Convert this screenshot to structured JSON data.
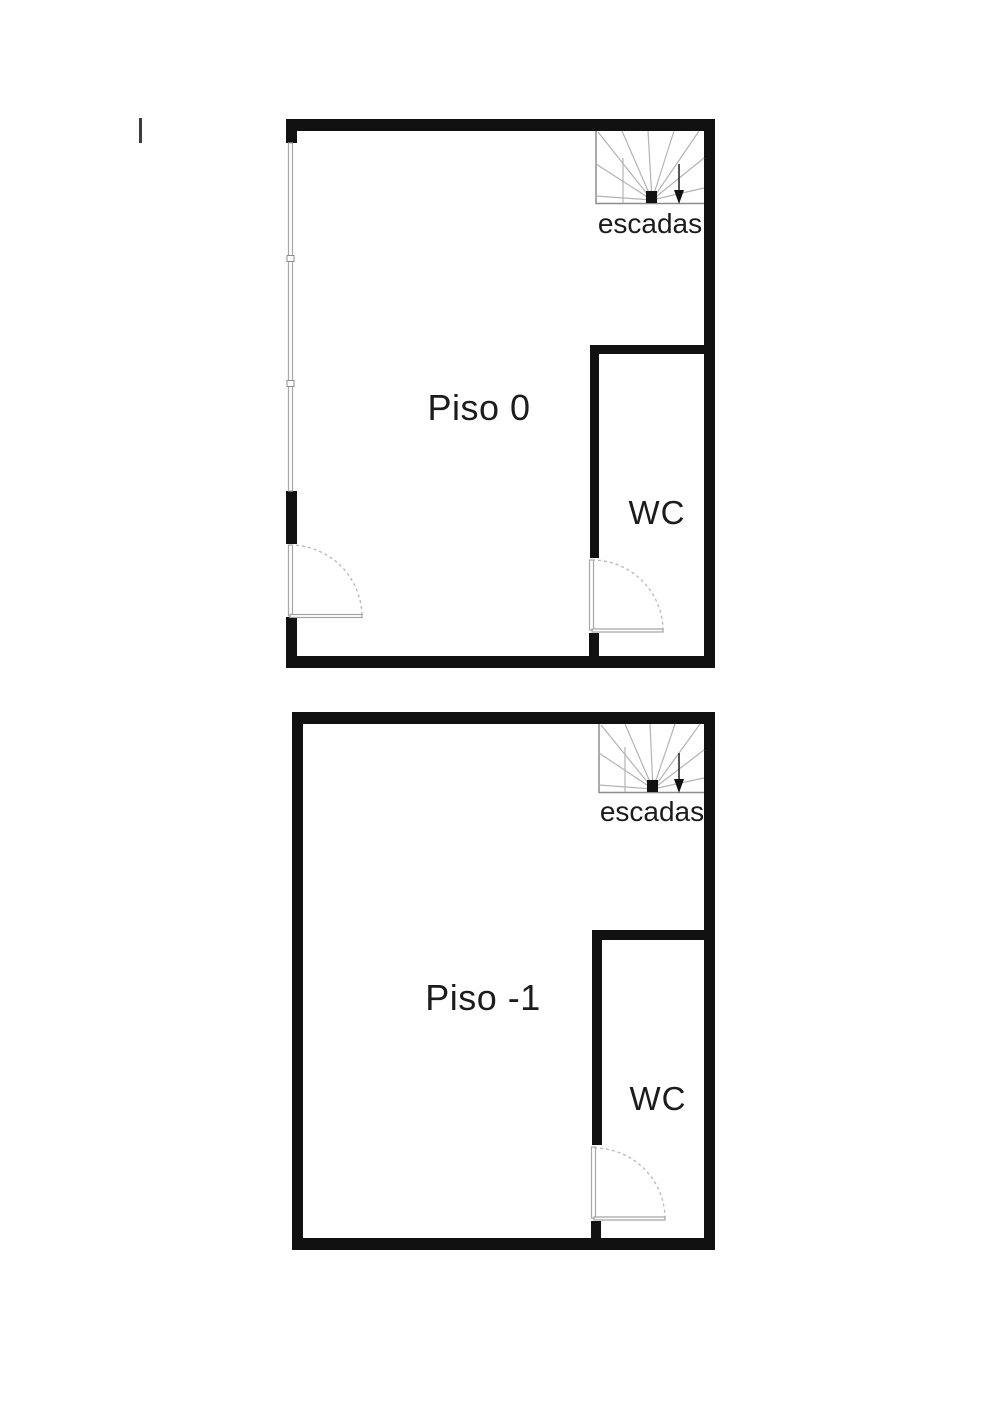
{
  "document": {
    "type": "floor-plan-drawing",
    "background_color": "#ffffff"
  },
  "colors": {
    "wall": "#111111",
    "window_line": "#a8a8a8",
    "door_swing": "#b8b8b8",
    "stairs_line": "#b4b4b4",
    "text": "#1c1c1c"
  },
  "floors": [
    {
      "id": "piso-0",
      "name_label": "Piso 0",
      "wc_label": "WC",
      "stairs_label": "escadas"
    },
    {
      "id": "piso-1",
      "name_label": "Piso -1",
      "wc_label": "WC",
      "stairs_label": "escadas"
    }
  ]
}
